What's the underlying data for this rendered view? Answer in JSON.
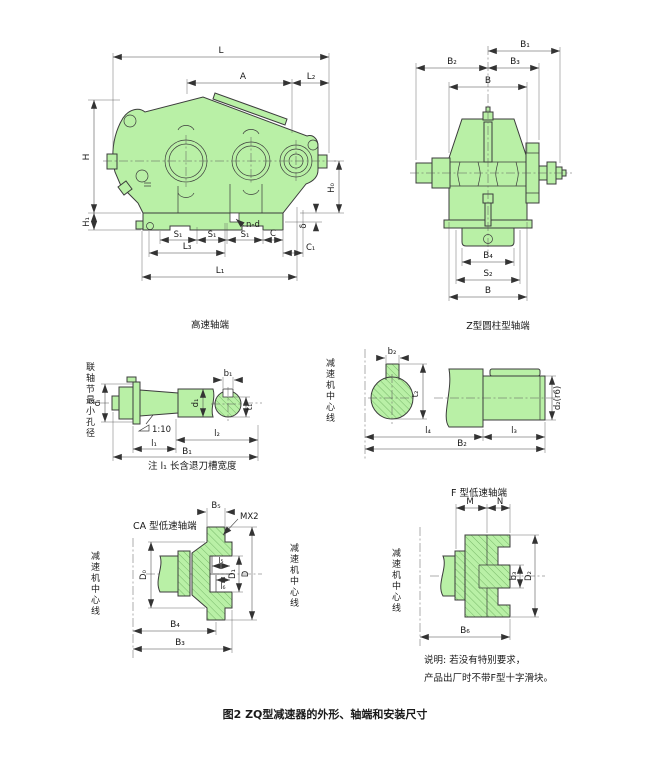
{
  "figure_caption": "图2 ZQ型减速器的外形、轴端和安装尺寸",
  "notes": {
    "line1": "说明: 若没有特别要求，",
    "line2": "产品出厂时不带F型十字滑块。"
  },
  "side_view": {
    "dim_L": "L",
    "dim_A": "A",
    "dim_L2": "L₂",
    "dim_H": "H",
    "dim_H1": "H₁",
    "dim_H0": "H₀",
    "dim_delta": "δ",
    "dim_nd": "n-d",
    "dim_C": "C",
    "dim_S1": "S₁",
    "dim_L3": "L₃",
    "dim_C1": "C₁",
    "dim_L1": "L₁"
  },
  "end_view": {
    "dim_B1": "B₁",
    "dim_B2": "B₂",
    "dim_B3": "B₃",
    "dim_B_top": "B",
    "dim_B4": "B₄",
    "dim_S2": "S₂",
    "dim_B_bottom": "B"
  },
  "high_speed_view": {
    "title": "高速轴端",
    "side_label": "联轴节最小孔径",
    "dim_dL": "dₗ",
    "dim_d1": "d₁",
    "dim_b1": "b₁",
    "dim_t1": "t₁",
    "taper": "1:10",
    "dim_l1": "l₁",
    "dim_l2": "l₂",
    "dim_B1": "B₁",
    "note": "注 l₁ 长含退刀槽宽度"
  },
  "z_view": {
    "title": "Z型圆柱型轴端",
    "side_label": "减速机中心线",
    "dim_b2": "b₂",
    "dim_t2": "t₂",
    "dim_d2": "d₂(r6)",
    "dim_l4": "l₄",
    "dim_l3": "l₃",
    "dim_B2": "B₂"
  },
  "ca_view": {
    "title": "CA 型低速轴端",
    "side_label_left": "减速机中心线",
    "side_label_right": "减速机中心线",
    "dim_B5": "B₅",
    "thread": "MX2",
    "dim_D0": "D₀",
    "dim_l5": "l₅",
    "dim_l6": "l₆",
    "dim_D1": "D₁",
    "dim_D": "D",
    "dim_B4": "B₄",
    "dim_B3": "B₃"
  },
  "f_view": {
    "title": "F 型低速轴端",
    "side_label": "减速机中心线",
    "dim_M": "M",
    "dim_N": "N",
    "dim_b3": "b₃",
    "dim_D2": "D₂",
    "dim_B6": "B₆"
  }
}
